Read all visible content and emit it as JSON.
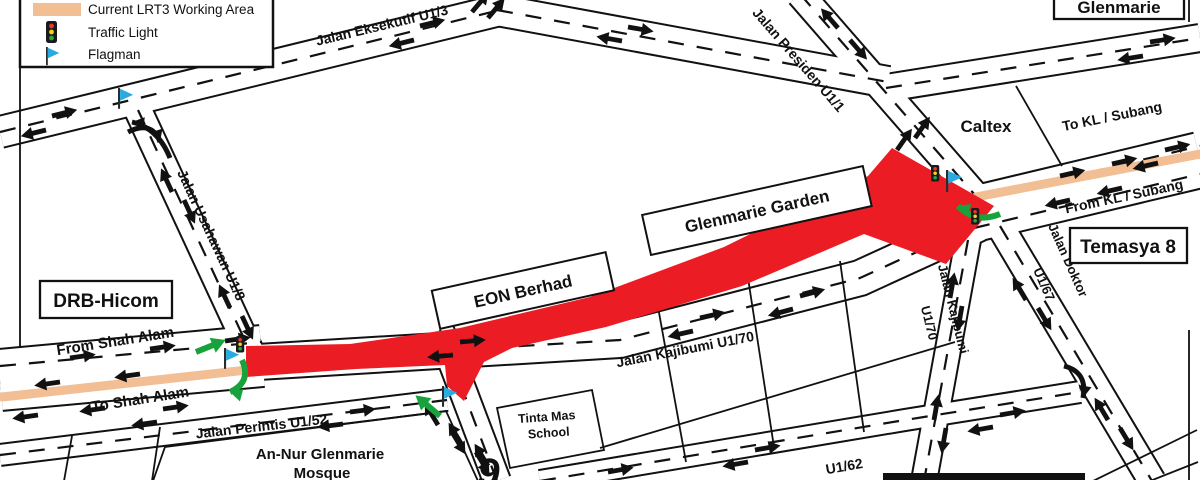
{
  "legend": {
    "items": [
      {
        "icon": "working-area-swatch",
        "label": "Current LRT3 Working Area"
      },
      {
        "icon": "traffic-light-icon",
        "label": "Traffic Light"
      },
      {
        "icon": "flagman-flag-icon",
        "label": "Flagman"
      }
    ]
  },
  "places": {
    "drb_hicom": "DRB-Hicom",
    "glenmarie": "Glenmarie",
    "caltex": "Caltex",
    "temasya8": "Temasya 8",
    "eon_berhad": "EON Berhad",
    "glenmarie_garden": "Glenmarie Garden",
    "tinta_mas_line1": "Tinta Mas",
    "tinta_mas_line2": "School",
    "mosque_line1": "An-Nur Glenmarie",
    "mosque_line2": "Mosque"
  },
  "roads": {
    "eksekutif": "Jalan Eksekutif U1/3",
    "presiden": "Jalan Presiden U1/1",
    "usahawan": "Jalan Usahawan U1/8",
    "kajibumi_main": "Jalan Kajibumi U1/70",
    "kajibumi_branch_line1": "Jalan Kajibumi",
    "kajibumi_branch_line2": "U1/70",
    "doktor_line1": "Jalan Doktor",
    "doktor_line2": "U1/67",
    "perintis": "Jalan Perintis U1/52",
    "u162": "U1/62"
  },
  "directions": {
    "from_shah_alam": "From Shah Alam",
    "to_shah_alam": "To Shah Alam",
    "to_kl": "To KL / Subang",
    "from_kl": "From KL / Subang"
  },
  "misc": {
    "route_glyph": "9"
  },
  "colors": {
    "working_area": "#F2BE93",
    "closure_red": "#EC1C24",
    "flag_blue": "#29ABE2",
    "arrow_green": "#18A23B"
  }
}
